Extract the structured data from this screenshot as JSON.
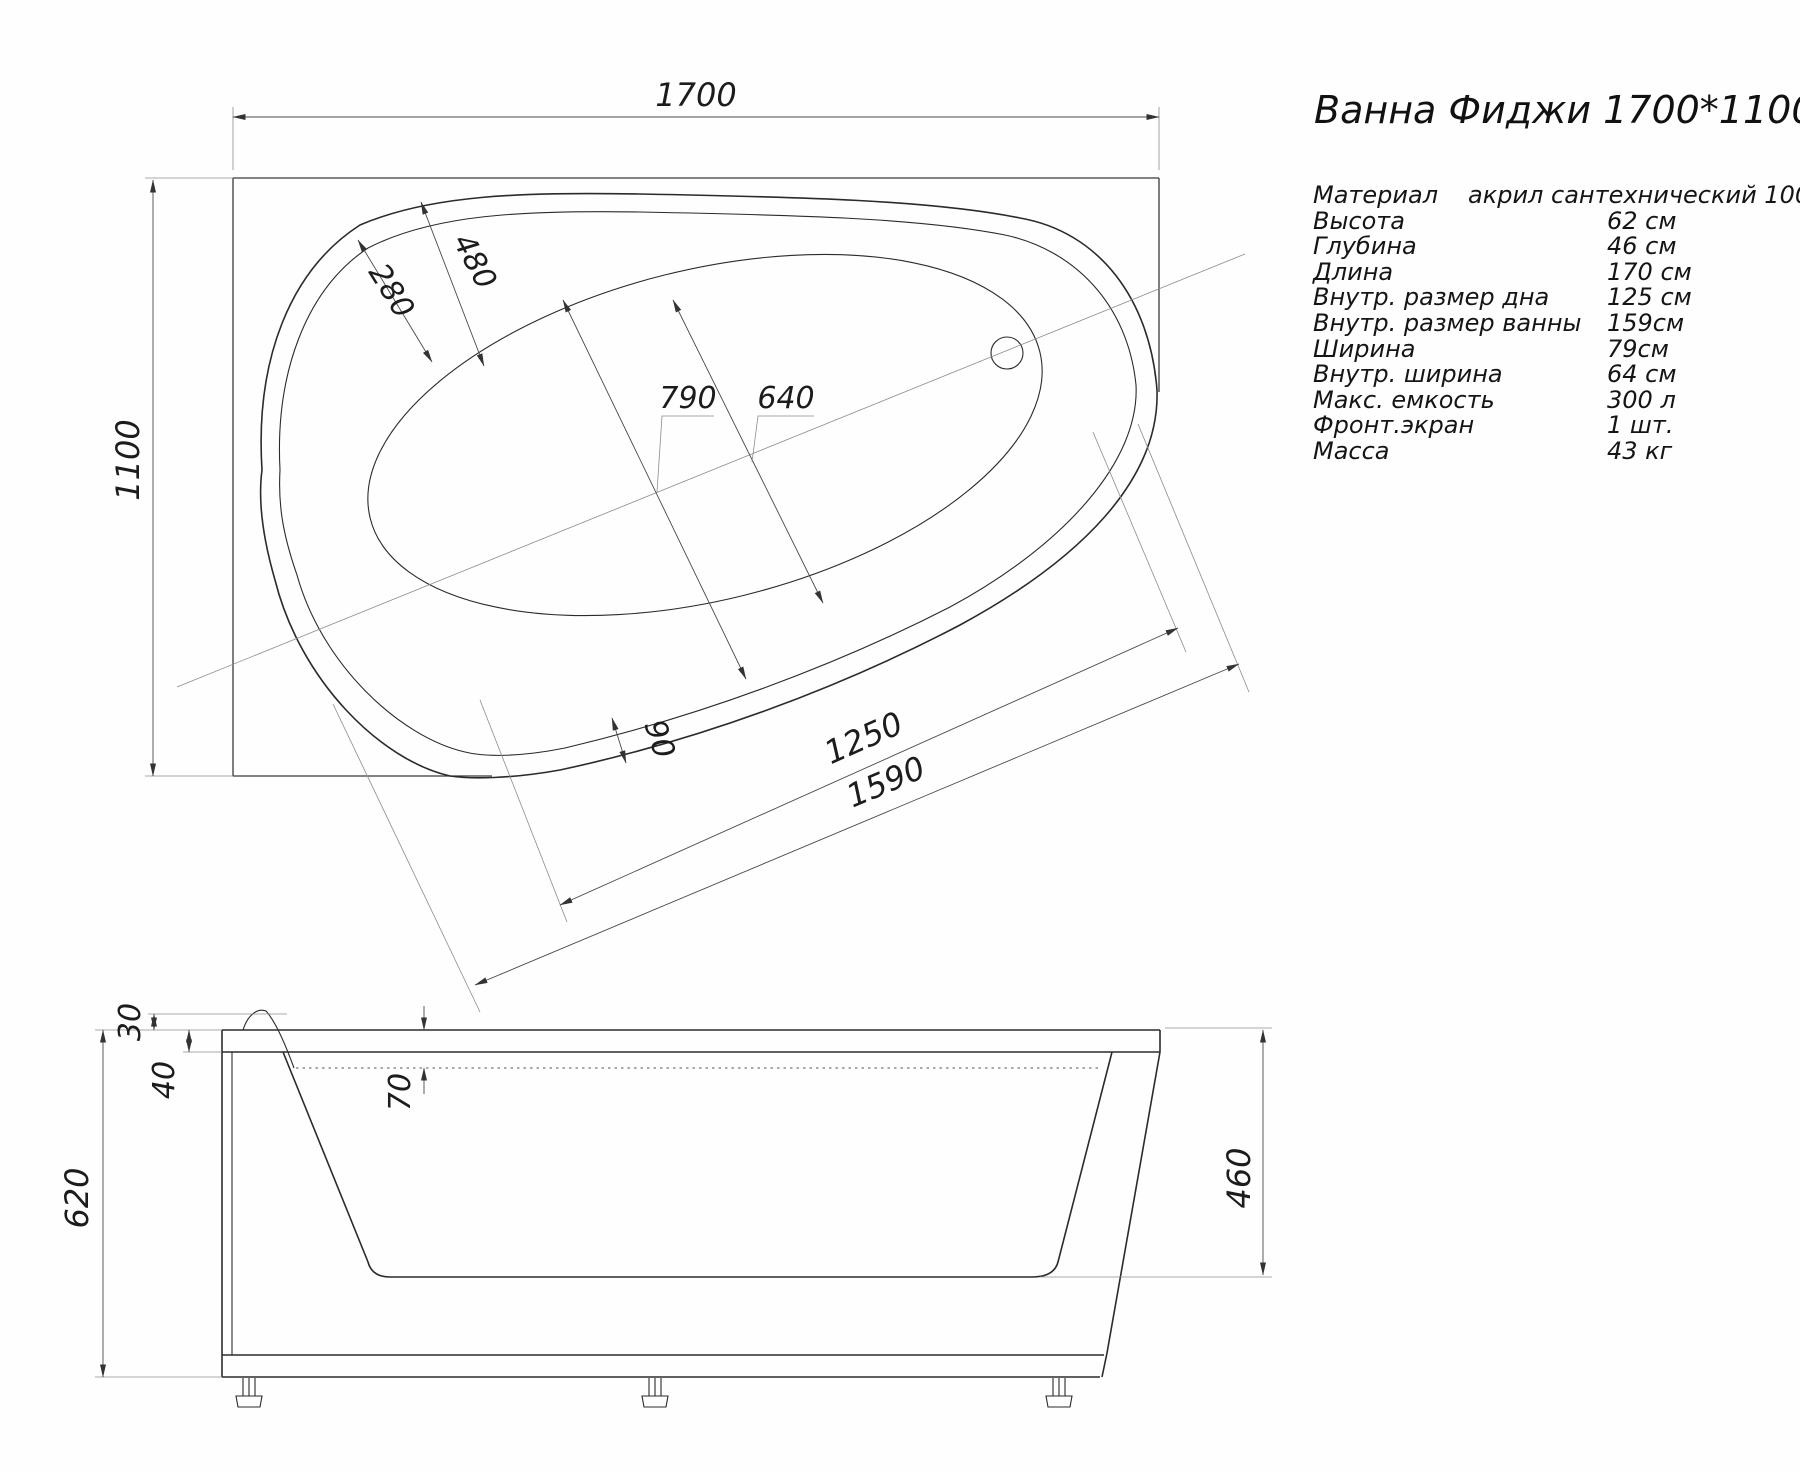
{
  "title": "Ванна Фиджи 1700*1100",
  "specs": {
    "rows": [
      {
        "label": "Материал",
        "value": "акрил сантехнический 100%"
      },
      {
        "label": "Высота",
        "value": "62 см"
      },
      {
        "label": "Глубина",
        "value": "46 см"
      },
      {
        "label": "Длина",
        "value": "170 см"
      },
      {
        "label": "Внутр. размер дна",
        "value": "125 см"
      },
      {
        "label": "Внутр. размер ванны",
        "value": "159см"
      },
      {
        "label": "Ширина",
        "value": "79см"
      },
      {
        "label": "Внутр. ширина",
        "value": "64 см"
      },
      {
        "label": "Макс. емкость",
        "value": "300 л"
      },
      {
        "label": "Фронт.экран",
        "value": "1 шт."
      },
      {
        "label": "Масса",
        "value": "43 кг"
      }
    ]
  },
  "top_view": {
    "dims": {
      "overall_length": "1700",
      "overall_width": "1100",
      "headrest_inner": "280",
      "headrest_outer": "480",
      "center_length": "790",
      "center_width": "640",
      "rim_width": "90",
      "bottom_length": "1250",
      "inner_length": "1590"
    }
  },
  "side_view": {
    "dims": {
      "lip_height": "30",
      "rim_height": "40",
      "ledge_depth": "70",
      "total_height": "620",
      "inner_depth": "460"
    }
  }
}
